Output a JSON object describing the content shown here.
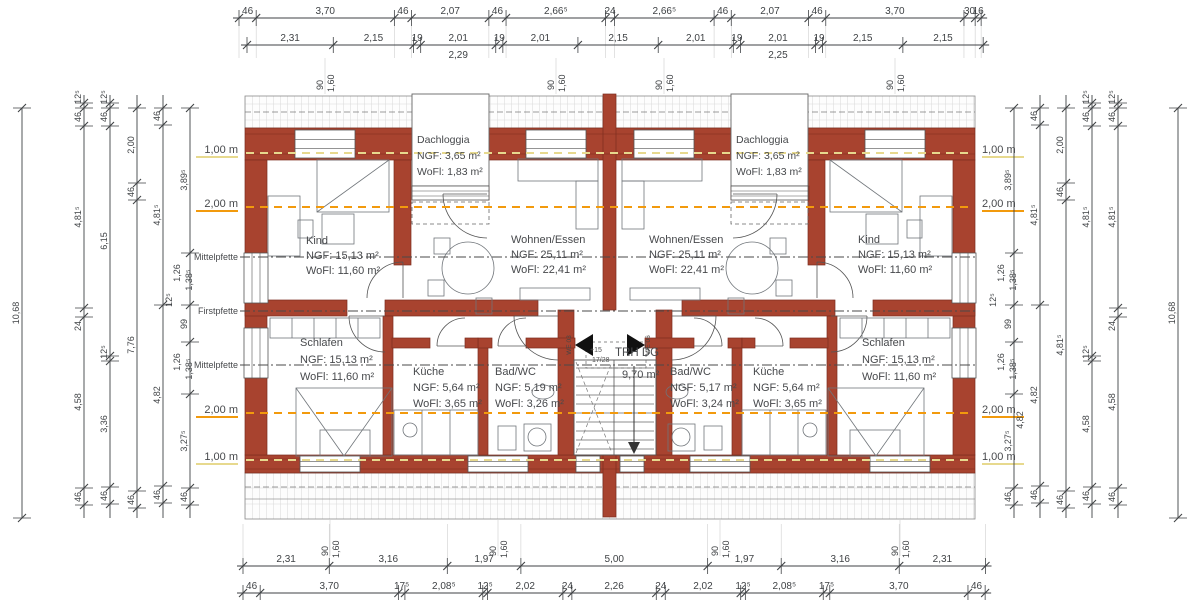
{
  "drawing": {
    "colors": {
      "wall": "#a8432f",
      "wall_edge": "#7c2d1f",
      "hatch": "#c6c6c6",
      "band_edge": "#8a8a8a",
      "dim": "#3f4245",
      "text": "#47494c",
      "furniture": "#70757a",
      "line_1m": "#e7d98e",
      "line_2m": "#f29a0d",
      "pfette": "#4a4a4a",
      "arrow": "#111111",
      "bg": "#ffffff"
    },
    "rooms": [
      {
        "id": "dachloggia-left",
        "lines": [
          "Dachloggia",
          "NGF:  3,65 m²",
          "WoFl: 1,83 m²"
        ],
        "x": 417,
        "y": 143,
        "lh": 16,
        "fs": 10.5
      },
      {
        "id": "dachloggia-right",
        "lines": [
          "Dachloggia",
          "NGF:  3,65 m²",
          "WoFl: 1,83 m²"
        ],
        "x": 736,
        "y": 143,
        "lh": 16,
        "fs": 10.5
      },
      {
        "id": "kind-left",
        "lines": [
          "Kind",
          "NGF:  15,13 m²",
          "WoFl: 11,60 m²"
        ],
        "x": 306,
        "y": 244,
        "lh": 15,
        "fs": 11
      },
      {
        "id": "wohnen-left",
        "lines": [
          "Wohnen/Essen",
          "NGF:  25,11 m²",
          "WoFl: 22,41 m²"
        ],
        "x": 511,
        "y": 243,
        "lh": 15,
        "fs": 11
      },
      {
        "id": "wohnen-right",
        "lines": [
          "Wohnen/Essen",
          "NGF:  25,11 m²",
          "WoFl: 22,41 m²"
        ],
        "x": 649,
        "y": 243,
        "lh": 15,
        "fs": 11
      },
      {
        "id": "kind-right",
        "lines": [
          "Kind",
          "NGF:  15,13 m²",
          "WoFl: 11,60 m²"
        ],
        "x": 858,
        "y": 243,
        "lh": 15,
        "fs": 11
      },
      {
        "id": "schlafen-left",
        "lines": [
          "Schlafen",
          "NGF:  15,13 m²",
          "WoFl: 11,60 m²"
        ],
        "x": 300,
        "y": 346,
        "lh": 17,
        "fs": 11
      },
      {
        "id": "kueche-left",
        "lines": [
          "Küche",
          "NGF:  5,64 m²",
          "WoFl: 3,65 m²"
        ],
        "x": 413,
        "y": 375,
        "lh": 16,
        "fs": 11
      },
      {
        "id": "bad-left",
        "lines": [
          "Bad/WC",
          "NGF:  5,19 m²",
          "WoFl: 3,26 m²"
        ],
        "x": 495,
        "y": 375,
        "lh": 16,
        "fs": 11
      },
      {
        "id": "bad-right",
        "lines": [
          "Bad/WC",
          "NGF:  5,17 m²",
          "WoFl: 3,24 m²"
        ],
        "x": 670,
        "y": 375,
        "lh": 16,
        "fs": 11
      },
      {
        "id": "kueche-right",
        "lines": [
          "Küche",
          "NGF:  5,64 m²",
          "WoFl: 3,65 m²"
        ],
        "x": 753,
        "y": 375,
        "lh": 16,
        "fs": 11
      },
      {
        "id": "schlafen-right",
        "lines": [
          "Schlafen",
          "NGF:  15,13 m²",
          "WoFl: 11,60 m²"
        ],
        "x": 862,
        "y": 346,
        "lh": 17,
        "fs": 11
      }
    ],
    "stair": {
      "label": "TRH DG",
      "area": "9,70 m²",
      "mark_plus": "+15",
      "mark_steps": "17/28",
      "unit_left": "WE 03",
      "unit_right": "WE 06"
    },
    "pfette_labels": [
      {
        "t": "Mittelpfette",
        "y": 257
      },
      {
        "t": "Firstpfette",
        "y": 311
      },
      {
        "t": "Mittelpfette",
        "y": 365
      }
    ],
    "height_labels": {
      "left": [
        {
          "t": "1,00 m",
          "y": 153,
          "k": "1"
        },
        {
          "t": "2,00 m",
          "y": 207,
          "k": "2"
        },
        {
          "t": "2,00 m",
          "y": 413,
          "k": "2"
        },
        {
          "t": "1,00 m",
          "y": 460,
          "k": "1"
        }
      ],
      "right": [
        {
          "t": "1,00 m",
          "y": 153,
          "k": "1"
        },
        {
          "t": "2,00 m",
          "y": 207,
          "k": "2"
        },
        {
          "t": "2,00 m",
          "y": 413,
          "k": "2"
        },
        {
          "t": "1,00 m",
          "y": 460,
          "k": "1"
        }
      ]
    },
    "window_dims": {
      "labels": [
        "90",
        "1,60"
      ],
      "top_x": [
        325,
        556,
        664,
        895
      ],
      "bottom_x": [
        330,
        498,
        720,
        900
      ]
    },
    "dims": {
      "scale_px_per_m": 37.35,
      "top1": {
        "y": 18,
        "x0": 239,
        "labels": [
          "46",
          "3,70",
          "46",
          "2,07",
          "46",
          "2,66⁵",
          "24",
          "2,66⁵",
          "46",
          "2,07",
          "46",
          "3,70",
          "30",
          "16"
        ]
      },
      "top2": {
        "y": 45,
        "x0": 247,
        "labels": [
          "2,31",
          "2,15",
          "19",
          "2,01",
          "19",
          "2,01",
          "2,15",
          "2,01",
          "19",
          "2,01",
          "19",
          "2,15",
          "2,15"
        ],
        "subs": [
          {
            "i": 3,
            "t": "2,29"
          },
          {
            "i": 9,
            "t": "2,25"
          }
        ]
      },
      "bottom1": {
        "y": 566,
        "x0": 243,
        "labels": [
          "2,31",
          "3,16",
          "1,97",
          "5,00",
          "1,97",
          "3,16",
          "2,31"
        ]
      },
      "bottom2": {
        "y": 593,
        "x0": 243,
        "labels": [
          "46",
          "3,70",
          "17⁵",
          "2,08⁵",
          "12⁵",
          "2,02",
          "24",
          "2,26",
          "24",
          "2,02",
          "12⁵",
          "2,08⁵",
          "17⁵",
          "3,70",
          "46"
        ]
      },
      "left_total": {
        "x": 22,
        "label": "10,68",
        "y1": 108,
        "y2": 518,
        "ly": 313
      },
      "right_total": {
        "x": 1178,
        "label": "10,68",
        "y1": 108,
        "y2": 518,
        "ly": 313
      },
      "left_cols": [
        {
          "x": 84,
          "y1": 95,
          "y2": 518,
          "ticks": [
            103,
            108,
            126,
            308,
            317,
            488,
            505
          ],
          "labels": [
            {
              "t": "12⁵",
              "y": 97
            },
            {
              "t": "46",
              "y": 117
            },
            {
              "t": "4,81⁵",
              "y": 217
            },
            {
              "t": "24",
              "y": 326
            },
            {
              "t": "4,58",
              "y": 402
            },
            {
              "t": "46",
              "y": 497
            }
          ]
        },
        {
          "x": 110,
          "y1": 95,
          "y2": 518,
          "ticks": [
            103,
            108,
            126,
            356,
            361,
            487,
            504
          ],
          "labels": [
            {
              "t": "12⁵",
              "y": 97
            },
            {
              "t": "46",
              "y": 117
            },
            {
              "t": "6,15",
              "y": 241
            },
            {
              "t": "12⁵",
              "y": 352
            },
            {
              "t": "3,36",
              "y": 424
            },
            {
              "t": "46",
              "y": 496
            }
          ]
        },
        {
          "x": 137,
          "y1": 95,
          "y2": 518,
          "ticks": [
            108,
            183,
            200,
            491,
            508
          ],
          "labels": [
            {
              "t": "2,00",
              "y": 145
            },
            {
              "t": "46",
              "y": 192
            },
            {
              "t": "7,76",
              "y": 345
            },
            {
              "t": "46",
              "y": 500
            }
          ]
        },
        {
          "x": 163,
          "y1": 95,
          "y2": 518,
          "ticks": [
            108,
            125,
            305,
            486,
            503
          ],
          "labels": [
            {
              "t": "46",
              "y": 116
            },
            {
              "t": "4,81⁵",
              "y": 215
            },
            {
              "t": "4,82",
              "y": 395
            },
            {
              "t": "46",
              "y": 495
            }
          ]
        },
        {
          "x": 190,
          "y1": 108,
          "y2": 518,
          "ticks": [
            108,
            253,
            305,
            342,
            394,
            488,
            505
          ],
          "labels": [
            {
              "t": "3,89⁵",
              "y": 180
            },
            {
              "t": "1,26",
              "y": 273,
              "dx": -7
            },
            {
              "t": "1,38⁵",
              "y": 280,
              "dx": 5
            },
            {
              "t": "99",
              "y": 324
            },
            {
              "t": "12⁵",
              "y": 300,
              "dx": -15
            },
            {
              "t": "1,26",
              "y": 362,
              "dx": -7
            },
            {
              "t": "1,38⁵",
              "y": 369,
              "dx": 5
            },
            {
              "t": "3,27⁵",
              "y": 441
            },
            {
              "t": "46",
              "y": 497
            }
          ]
        }
      ],
      "right_cols": [
        {
          "x": 1014,
          "y1": 108,
          "y2": 518,
          "ticks": [
            108,
            253,
            305,
            342,
            394,
            488,
            505
          ],
          "labels": [
            {
              "t": "3,89⁵",
              "y": 180
            },
            {
              "t": "1,26",
              "y": 273,
              "dx": -7
            },
            {
              "t": "1,38⁵",
              "y": 280,
              "dx": 5
            },
            {
              "t": "99",
              "y": 324
            },
            {
              "t": "12⁵",
              "y": 300,
              "dx": -15
            },
            {
              "t": "1,26",
              "y": 362,
              "dx": -7
            },
            {
              "t": "1,38⁵",
              "y": 369,
              "dx": 5
            },
            {
              "t": "4,82",
              "y": 420,
              "dx": 12
            },
            {
              "t": "3,27⁵",
              "y": 441
            },
            {
              "t": "46",
              "y": 497
            }
          ]
        },
        {
          "x": 1040,
          "y1": 95,
          "y2": 518,
          "ticks": [
            108,
            125,
            305,
            486,
            503
          ],
          "labels": [
            {
              "t": "46",
              "y": 116
            },
            {
              "t": "4,81⁵",
              "y": 215
            },
            {
              "t": "4,82",
              "y": 395
            },
            {
              "t": "46",
              "y": 495
            }
          ]
        },
        {
          "x": 1066,
          "y1": 95,
          "y2": 518,
          "ticks": [
            108,
            183,
            200,
            491,
            508
          ],
          "labels": [
            {
              "t": "2,00",
              "y": 145
            },
            {
              "t": "46",
              "y": 192
            },
            {
              "t": "4,81⁵",
              "y": 345
            },
            {
              "t": "46",
              "y": 500
            }
          ]
        },
        {
          "x": 1092,
          "y1": 95,
          "y2": 518,
          "ticks": [
            103,
            108,
            126,
            356,
            361,
            487,
            504
          ],
          "labels": [
            {
              "t": "12⁵",
              "y": 97
            },
            {
              "t": "46",
              "y": 117
            },
            {
              "t": "4,81⁵",
              "y": 217
            },
            {
              "t": "12⁵",
              "y": 352
            },
            {
              "t": "4,58",
              "y": 424
            },
            {
              "t": "46",
              "y": 496
            }
          ]
        },
        {
          "x": 1118,
          "y1": 95,
          "y2": 518,
          "ticks": [
            103,
            108,
            126,
            308,
            317,
            488,
            505
          ],
          "labels": [
            {
              "t": "12⁵",
              "y": 97
            },
            {
              "t": "46",
              "y": 117
            },
            {
              "t": "4,81⁵",
              "y": 217
            },
            {
              "t": "24",
              "y": 326
            },
            {
              "t": "4,58",
              "y": 402
            },
            {
              "t": "46",
              "y": 497
            }
          ]
        }
      ]
    }
  }
}
